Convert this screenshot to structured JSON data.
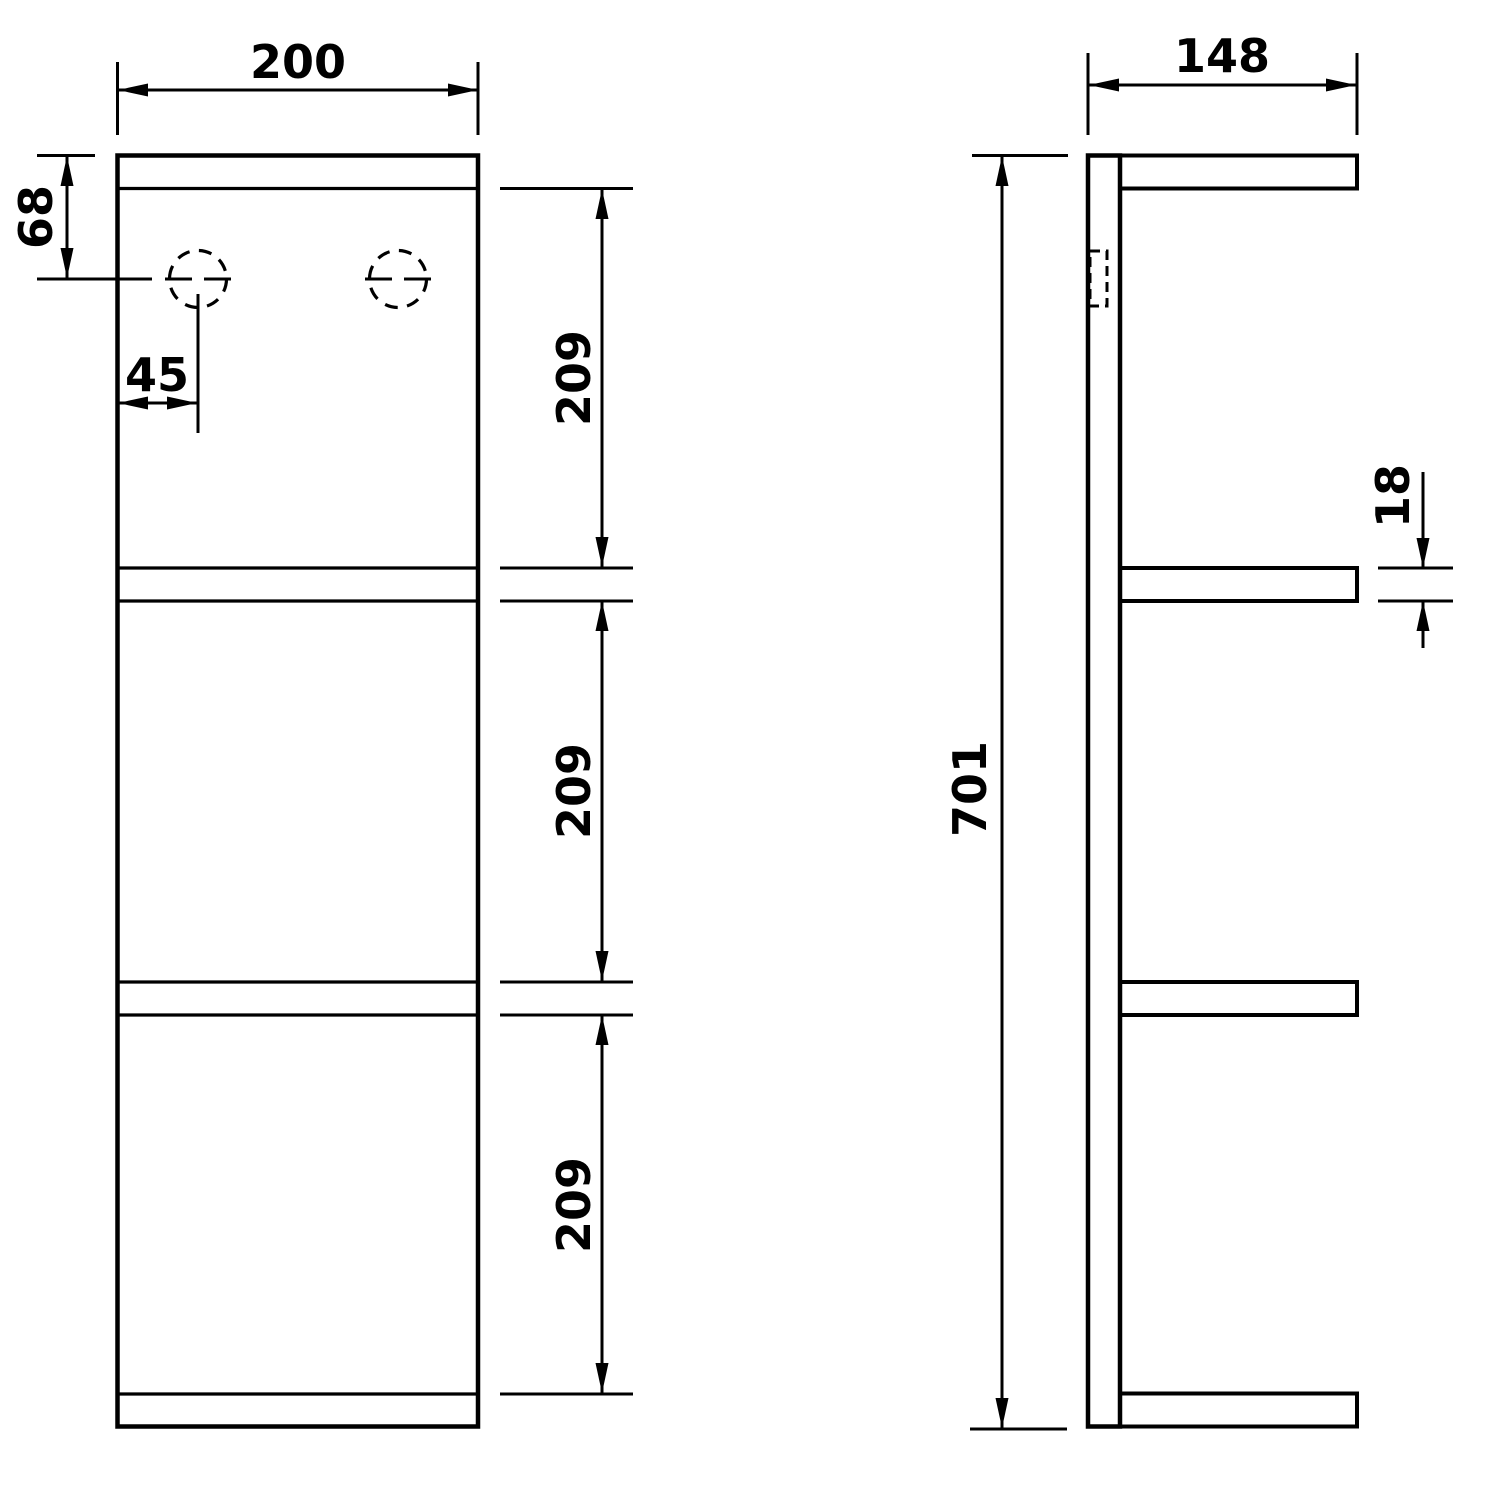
{
  "front_view": {
    "width": "200",
    "hole_offset_top": "68",
    "hole_offset_left": "45",
    "compartments": [
      "209",
      "209",
      "209"
    ]
  },
  "side_view": {
    "depth": "148",
    "height": "701",
    "board_thickness": "18"
  },
  "colors": {
    "line": "#000000",
    "background": "#ffffff"
  }
}
